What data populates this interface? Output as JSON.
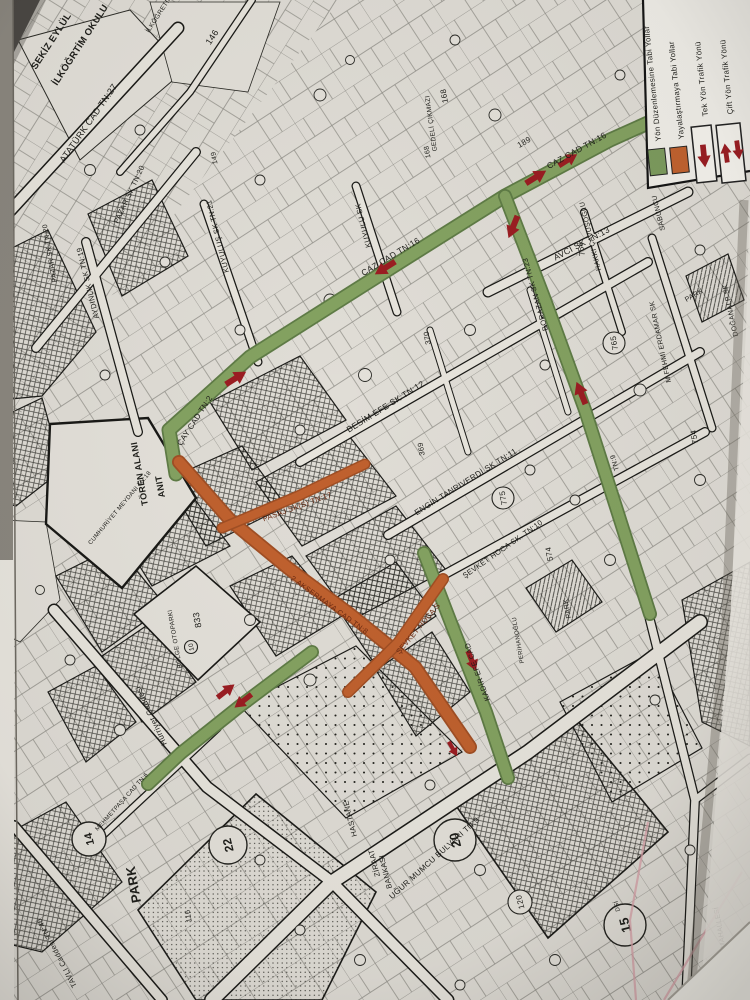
{
  "legend": {
    "items": [
      {
        "label": "Yön Düzenlemesine Tabi Yollar",
        "swatch_color": "#7d9c5e",
        "symbol": "green-swatch"
      },
      {
        "label": "Yayalaştırmaya Tabi Yollar",
        "swatch_color": "#c2622f",
        "symbol": "orange-swatch"
      },
      {
        "label": "Tek Yön Trafik Yönü",
        "symbol": "single-down-arrow"
      },
      {
        "label": "Çift Yön Trafik Yönü",
        "symbol": "two-way-arrows"
      }
    ],
    "arrow_color": "#9b1d22"
  },
  "colors": {
    "regulated_road_green": "#7d9c5e",
    "pedestrian_road_orange": "#c2622f",
    "traffic_arrow_red": "#9b1d22",
    "ink": "#1d1d19",
    "paper": "#e4e1da"
  },
  "labels": {
    "streets": [
      "ATATÜRK CAD TN:27",
      "PAZAR SK TN:20",
      "PAZAR SK TN:20",
      "AYDINLIK SK TN:19",
      "KUYULUŞ SK TN:21",
      "KUYULU SK",
      "GEDELİ ÇIKMAZI",
      "CAZ CAD TN:16",
      "CAZ CAD TN:16",
      "AVCI SK TN:13",
      "HAKKI ÇAVUŞOĞLU",
      "SABUNCU",
      "M.FEHMİ ERDAMAR SK",
      "DOĞANALP SK",
      "BORAZAN SK TN:23",
      "TN:9",
      "BESİM EFE SK TN:12",
      "ENGİN TANRIVERDİ SK TN:11",
      "ŞEVKET HOCA SK. TN:10",
      "ÇAY CAD TN:2",
      "PASAJ SK(S) TN:17",
      "2.AKSERMAYA CAD TN:8",
      "ŞEVKET HOCA S",
      "KADİR EFE CAD",
      "Hürriyet Caddesi",
      "UĞUR MUMCU BULVARI TN:9",
      "TAVLI Caddesi TN:46",
      "MEHMETPAŞA CAD TN:6",
      "CUMHURİYET MEYDANI TN:18"
    ],
    "areas": [
      "SEKİZ EYLÜL",
      "İLKÖĞRTİM OKULU",
      "İLKÖĞRETİM OKULU",
      "TÖREN ALANI",
      "ANIT",
      "BÖLGE OTOPARKI",
      "HASTANE",
      "ZİRAAT",
      "BANKASI",
      "PARK",
      "PARK",
      "PARK",
      "PERİHANOĞLU",
      "HACIKADI MAHALLESİ",
      "DSİ"
    ],
    "parcels": [
      "146",
      "149",
      "168",
      "168",
      "189",
      "756",
      "765",
      "775",
      "574",
      "754",
      "370",
      "369",
      "833",
      "10",
      "116",
      "120",
      "22",
      "14",
      "20",
      "15"
    ]
  }
}
